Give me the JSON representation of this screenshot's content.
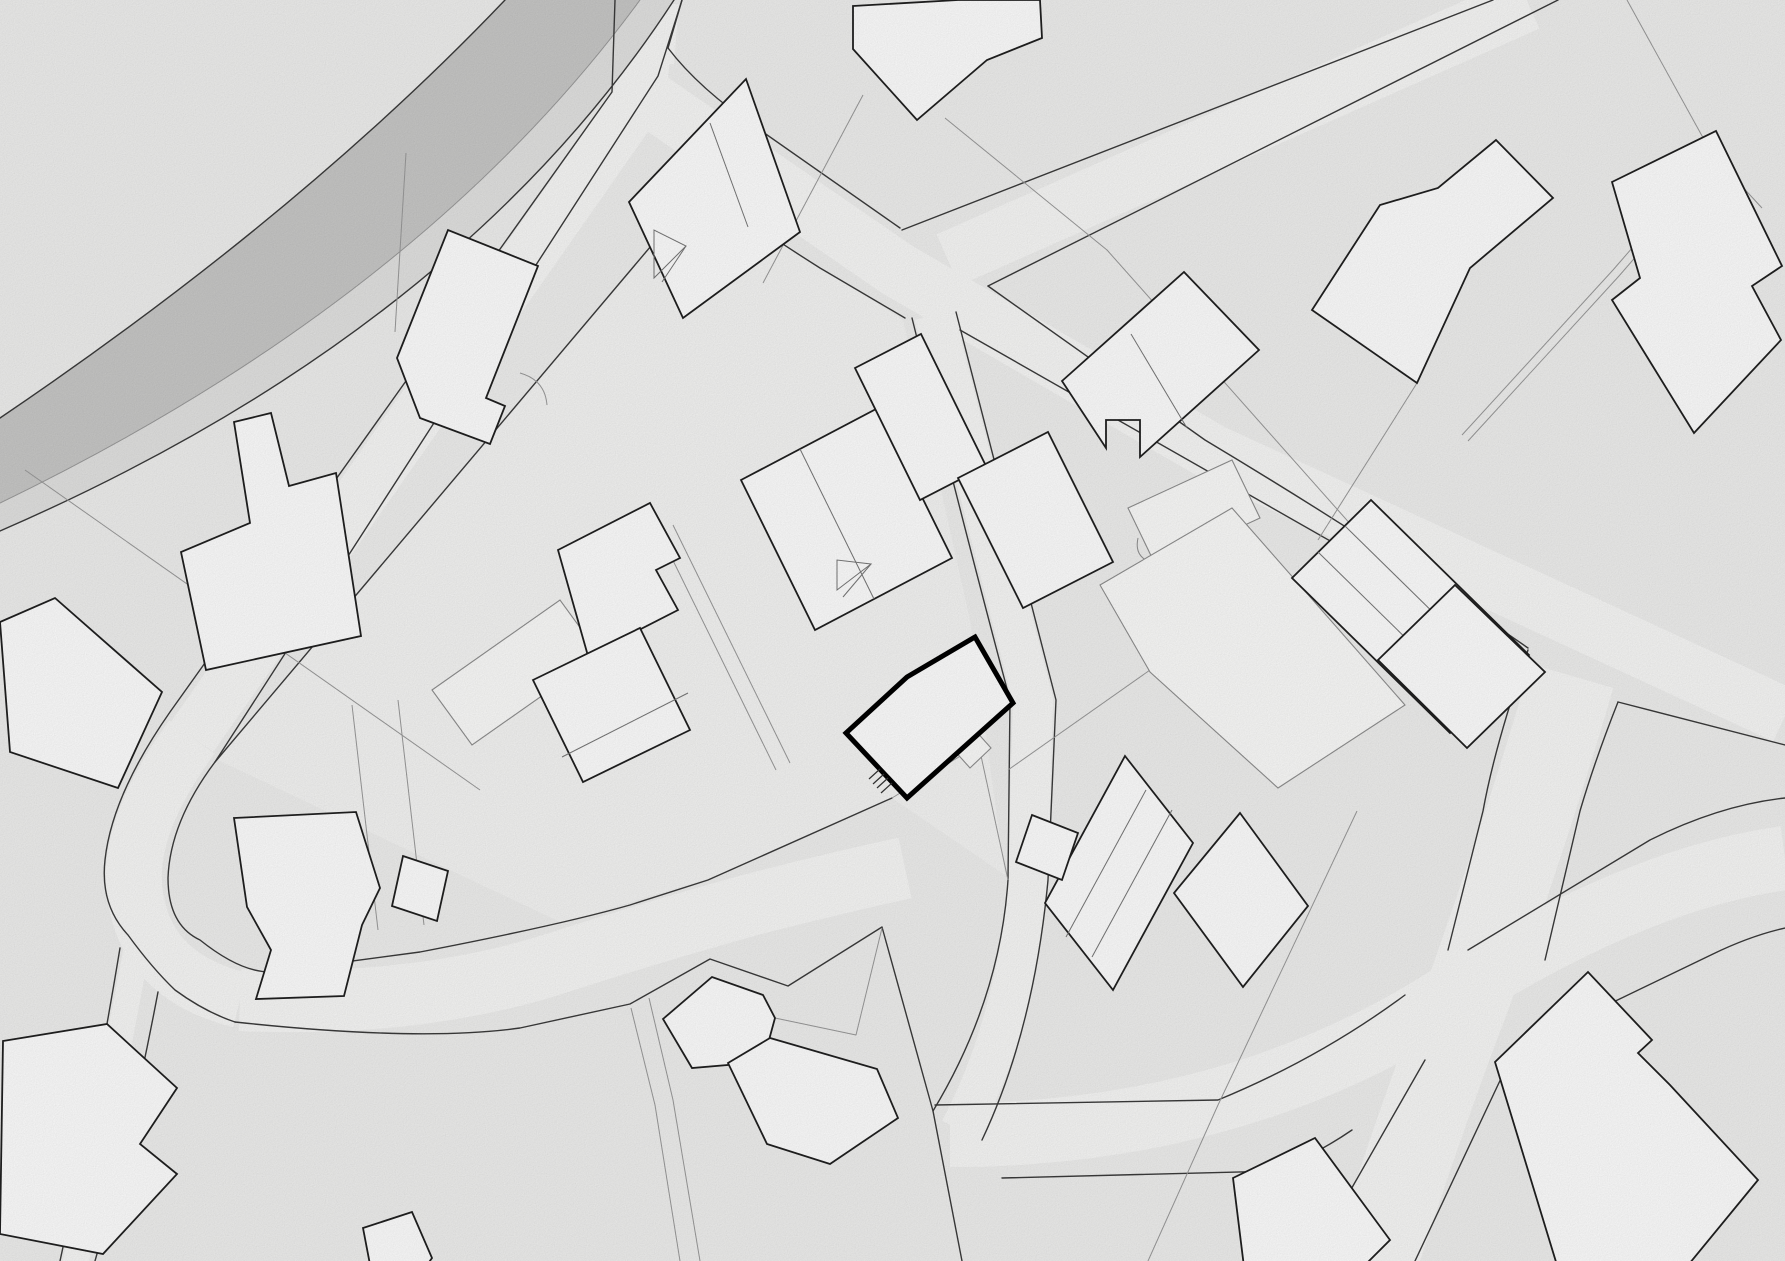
{
  "document": {
    "kind": "site-plan-drawing",
    "width": 1785,
    "height": 1261
  },
  "colors": {
    "background": "#f0f0ef",
    "parcel_light": "#f6f6f5",
    "road_fill": "#f9f9f8",
    "road_edge": "#3b3b3b",
    "road_edge_light": "#9a9a9a",
    "asphalt_gray": "#c9c9c8",
    "sidewalk_gray": "#e3e3e2",
    "building_fill": "#ffffff",
    "building_stroke": "#202020",
    "annex_stroke": "#8f8f8f",
    "annex_fill": "#fcfcfb",
    "parcel_line": "#9a9a9a",
    "detail_line": "#777777",
    "highlight_stroke": "#000000"
  },
  "chart_data": {
    "type": "table",
    "note": "no numeric chart content; map geometry below"
  },
  "map": {
    "parcel_highlights": [
      {
        "name": "parcel-project",
        "points": "700,190 903,320 970,620 1005,875 892,798 710,878 562,923 218,760",
        "fill": "#f6f6f5"
      }
    ],
    "gray_road": {
      "asphalt": "M 505,0 Q 300,215 0,418 L 0,503 Q 420,300 640,0 Z",
      "sidewalk": "M 640,0 Q 420,300 0,503 L 0,531 Q 458,332 674,0 Z"
    },
    "road_centerlines": [
      {
        "name": "road-upper-left-branch",
        "d": "M 648,18 L 640,98 L 192,737",
        "w": 52
      },
      {
        "name": "road-hook",
        "d": "M 192,737 Q 120,835 137,905 Q 152,978 240,1000",
        "w": 56
      },
      {
        "name": "road-lower-loop",
        "d": "M 240,1000 Q 420,1008 560,962 Q 660,930 750,905 Q 840,882 905,868",
        "w": 62
      },
      {
        "name": "road-central-south",
        "d": "M 934,315 Q 986,520 1033,700 L 1028,880 Q 1017,1020 960,1130",
        "w": 40
      },
      {
        "name": "road-southeast",
        "d": "M 950,1135 Q 1240,1135 1460,990 Q 1640,878 1785,858",
        "w": 64
      },
      {
        "name": "road-south-vertical",
        "d": "M 1572,676 Q 1530,820 1468,995 Q 1420,1120 1372,1270",
        "w": 86
      },
      {
        "name": "road-top-right",
        "d": "M 948,260 L 1528,3",
        "w": 56
      },
      {
        "name": "road-main-diagonal",
        "d": "M 622,80 L 898,270 L 1212,452 L 1785,716",
        "w": 56
      },
      {
        "name": "road-bottom-left-narrow",
        "d": "M 138,942 Q 108,1100 74,1270",
        "w": 26
      },
      {
        "name": "road-top-stub",
        "d": "M 650,2 L 645,62",
        "w": 58
      }
    ],
    "road_edges": [
      {
        "name": "gray-road-outer-edge",
        "d": "M 505,0 Q 300,215 0,418"
      },
      {
        "name": "gray-road-sidewalk-sep",
        "d": "M 640,0 Q 420,300 0,503",
        "light": true
      },
      {
        "name": "gray-road-inner-edge",
        "d": "M 674,0 Q 458,332 0,531"
      },
      {
        "name": "branch-left-edge",
        "d": "M 615,0 L 612,92 L 170,712 Q 112,795 105,860 Q 100,905 128,935 Q 152,968 175,990 Q 205,1012 235,1022"
      },
      {
        "name": "branch-right-edge",
        "d": "M 682,0 L 658,76 L 215,762 Q 170,822 168,878 Q 168,925 200,940 Q 240,972 270,972 L 420,952 Q 560,925 630,905 L 708,880 L 892,798"
      },
      {
        "name": "loop-south-edge",
        "d": "M 235,1022 Q 420,1042 520,1028 L 630,1004 L 710,959 L 788,986 L 882,927 L 933,1111 L 962,1261"
      },
      {
        "name": "main-upper-edge-a",
        "d": "M 682,0 L 668,48 Q 700,90 760,130 L 900,228"
      },
      {
        "name": "main-upper-edge-b",
        "d": "M 988,286 L 1205,440 Q 1380,545 1528,648"
      },
      {
        "name": "main-lower-edge-a",
        "d": "M 215,762 L 700,188 Q 760,230 820,268 L 905,318"
      },
      {
        "name": "main-lower-edge-b",
        "d": "M 960,330 L 1525,652"
      },
      {
        "name": "main-lower-edge-c",
        "d": "M 1618,702 L 1785,745"
      },
      {
        "name": "topright-road-left-edge",
        "d": "M 902,230 L 1493,0"
      },
      {
        "name": "topright-road-right-edge",
        "d": "M 988,286 L 1558,0"
      },
      {
        "name": "vertical-road-left-a",
        "d": "M 1528,650 Q 1495,745 1483,811 L 1448,950"
      },
      {
        "name": "vertical-road-left-b",
        "d": "M 1425,1060 L 1310,1261"
      },
      {
        "name": "vertical-road-right-a",
        "d": "M 1618,702 Q 1595,760 1580,811 L 1545,960"
      },
      {
        "name": "vertical-road-right-b",
        "d": "M 1505,1070 L 1415,1261"
      },
      {
        "name": "southeast-road-upper-a",
        "d": "M 935,1105 L 1218,1100 Q 1320,1058 1405,995"
      },
      {
        "name": "southeast-road-upper-b",
        "d": "M 1468,950 L 1650,840 Q 1720,805 1785,798"
      },
      {
        "name": "southeast-road-lower-a",
        "d": "M 1002,1178 L 1277,1171 Q 1320,1152 1352,1130"
      },
      {
        "name": "southeast-road-lower-b",
        "d": "M 1518,1048 L 1713,954 Q 1750,936 1785,928"
      },
      {
        "name": "central-road-left-edge",
        "d": "M 912,318 Q 962,520 1010,700 L 1008,880 Q 1000,1000 933,1111"
      },
      {
        "name": "central-road-right-edge",
        "d": "M 956,312 Q 1010,520 1056,700 L 1048,880 Q 1034,1030 982,1140"
      },
      {
        "name": "narrow-road-left-edge",
        "d": "M 120,948 Q 95,1100 60,1261"
      },
      {
        "name": "narrow-road-right-edge",
        "d": "M 158,992 Q 130,1140 95,1261"
      }
    ],
    "parcel_lines": [
      {
        "name": "parcel-line-nw",
        "d": "M 25,470 L 480,790"
      },
      {
        "name": "parcel-line-top-center",
        "d": "M 863,95 L 763,283"
      },
      {
        "name": "parcel-line-top-long",
        "d": "M 945,118 L 1107,250 L 1400,580"
      },
      {
        "name": "parcel-line-center-east",
        "d": "M 1008,770 L 1150,670"
      },
      {
        "name": "parcel-path-ne-a",
        "d": "M 1712,156 L 1613,270 L 1462,435"
      },
      {
        "name": "parcel-path-ne-b",
        "d": "M 1718,162 L 1619,276 L 1468,441"
      },
      {
        "name": "parcel-pair-center-a",
        "d": "M 673,525 L 790,763"
      },
      {
        "name": "parcel-pair-center-b",
        "d": "M 659,532 L 776,770"
      },
      {
        "name": "parcel-line-se",
        "d": "M 1357,811 L 1218,1105 L 1148,1261"
      },
      {
        "name": "parcel-line-pentagon",
        "d": "M 775,1018 L 856,1035 L 882,928"
      },
      {
        "name": "parcel-line-right",
        "d": "M 1417,383 L 1318,540"
      },
      {
        "name": "parcel-line-nw-short",
        "d": "M 406,153 L 395,332"
      },
      {
        "name": "footpath-south-a",
        "d": "M 649,998 L 673,1100 L 700,1261"
      },
      {
        "name": "footpath-south-b",
        "d": "M 631,1008 L 655,1105 L 680,1261"
      },
      {
        "name": "footpath-west-a",
        "d": "M 352,705 L 378,930"
      },
      {
        "name": "footpath-west-b",
        "d": "M 398,700 L 424,925"
      },
      {
        "name": "driveway-project",
        "d": "M 892,798 L 975,747"
      },
      {
        "name": "parcel-line-top-edge",
        "d": "M 1627,0 L 1712,154"
      },
      {
        "name": "parcel-line-top-edge-b",
        "d": "M 1712,154 L 1762,208"
      },
      {
        "name": "parcel-line-project-se",
        "d": "M 978,742 L 1008,880"
      },
      {
        "name": "parcel-arc-nw",
        "d": "M 520,373 Q 545,380 547,405"
      }
    ],
    "annex_buildings": [
      {
        "name": "annex-shed-arc",
        "points": "1128,508 1232,460 1260,518 1156,566",
        "extra": "M 1150,562 q -16,-6 -12,-24"
      },
      {
        "name": "annex-long-shed",
        "points": "432,690 560,600 600,655 472,745"
      },
      {
        "name": "annex-small-shed",
        "points": "953,749 974,729 991,748 970,768"
      },
      {
        "name": "annex-large-hall",
        "points": "1100,585 1232,508 1405,705 1278,788 1150,672"
      }
    ],
    "buildings": [
      {
        "name": "building-gable-north",
        "points": "629,202 746,79 800,232 683,318",
        "interior": [
          [
            "710,123",
            "748,227"
          ]
        ]
      },
      {
        "name": "building-top-irregular",
        "points": "853,6 958,0 1040,0 1042,38 987,60 917,120 853,49"
      },
      {
        "name": "building-ne-angular",
        "points": "1496,140 1553,198 1470,268 1417,383 1312,310 1380,205 1438,188"
      },
      {
        "name": "building-far-ne",
        "points": "1612,182 1716,131 1782,266 1752,286 1781,340 1694,433 1612,300 1640,278"
      },
      {
        "name": "building-nw-notched",
        "points": "397,358 448,230 538,266 486,398 505,406 490,444 420,418"
      },
      {
        "name": "building-west-tower",
        "points": "234,422 271,413 289,486 336,473 361,636 206,670 181,552 250,523"
      },
      {
        "name": "building-west-edge",
        "points": "0,622 55,598 162,692 118,788 10,752"
      },
      {
        "name": "building-center-west-a",
        "points": "558,550 650,503 680,558 656,570 678,610 588,656"
      },
      {
        "name": "building-center-west-b",
        "points": "533,680 640,628 690,730 583,782",
        "interior": [
          [
            "562,757",
            "688,693"
          ]
        ]
      },
      {
        "name": "building-center-gabled",
        "points": "741,480 878,408 952,558 815,630",
        "interior": [
          [
            "800,449",
            "874,599"
          ]
        ]
      },
      {
        "name": "building-center-upper",
        "points": "855,368 921,334 986,466 920,500"
      },
      {
        "name": "building-center-east",
        "points": "958,478 1048,432 1113,562 1023,608"
      },
      {
        "name": "building-ne-notch-pair",
        "points": "1062,381 1184,272 1259,350 1140,457 1140,420 1106,420 1106,448",
        "interior": [
          [
            "1131,334",
            "1187,428"
          ]
        ]
      },
      {
        "name": "building-mid-east-long",
        "points": "1125,756 1193,843 1113,990 1045,903",
        "interior": [
          [
            "1146,790",
            "1066,937"
          ],
          [
            "1172,810",
            "1092,957"
          ]
        ]
      },
      {
        "name": "building-mid-east-wing",
        "points": "1032,815 1078,833 1062,880 1016,862"
      },
      {
        "name": "building-mid-east-square",
        "points": "1240,813 1308,906 1243,987 1174,893"
      },
      {
        "name": "building-east-divided",
        "points": "1292,578 1371,500 1529,655 1450,733",
        "interior": [
          [
            "1318,552",
            "1476,707"
          ],
          [
            "1345,526",
            "1503,681"
          ]
        ]
      },
      {
        "name": "building-east-square",
        "points": "1378,660 1455,585 1545,672 1467,748"
      },
      {
        "name": "building-pentagon-small",
        "points": "663,1019 712,977 763,995 775,1018 763,1062 692,1068"
      },
      {
        "name": "building-pentagon-large",
        "points": "728,1063 770,1038 877,1069 898,1118 830,1164 767,1144"
      },
      {
        "name": "building-loop-L",
        "points": "234,818 356,812 380,888 362,925 344,996 256,999 271,950 247,907"
      },
      {
        "name": "building-loop-square",
        "points": "403,856 448,871 437,921 392,906"
      },
      {
        "name": "building-sw-large",
        "points": "3,1041 107,1024 177,1088 140,1144 177,1174 103,1254 0,1234"
      },
      {
        "name": "building-se-large",
        "points": "1495,1062 1588,972 1652,1040 1638,1053 1670,1085 1758,1180 1680,1275 1560,1275"
      },
      {
        "name": "building-south-small",
        "points": "1233,1178 1315,1138 1390,1240 1355,1275 1245,1275"
      },
      {
        "name": "building-bottom-small",
        "points": "363,1228 412,1212 432,1258 420,1275 372,1275"
      }
    ],
    "gables": [
      {
        "name": "gable-mark-north",
        "triangle": "654,230 654,278 686,246",
        "line": "M 686,246 L 662,282"
      },
      {
        "name": "gable-mark-center",
        "triangle": "837,560 837,590 871,564",
        "line": "M 871,564 L 843,597"
      }
    ],
    "highlight_building": {
      "name": "project-building",
      "points": "975,637 1013,703 907,798 846,733 907,677",
      "stairs": [
        "M 880,769 L 869,779",
        "M 884,774 L 873,784",
        "M 888,778 L 877,788",
        "M 892,783 L 881,793"
      ]
    }
  }
}
